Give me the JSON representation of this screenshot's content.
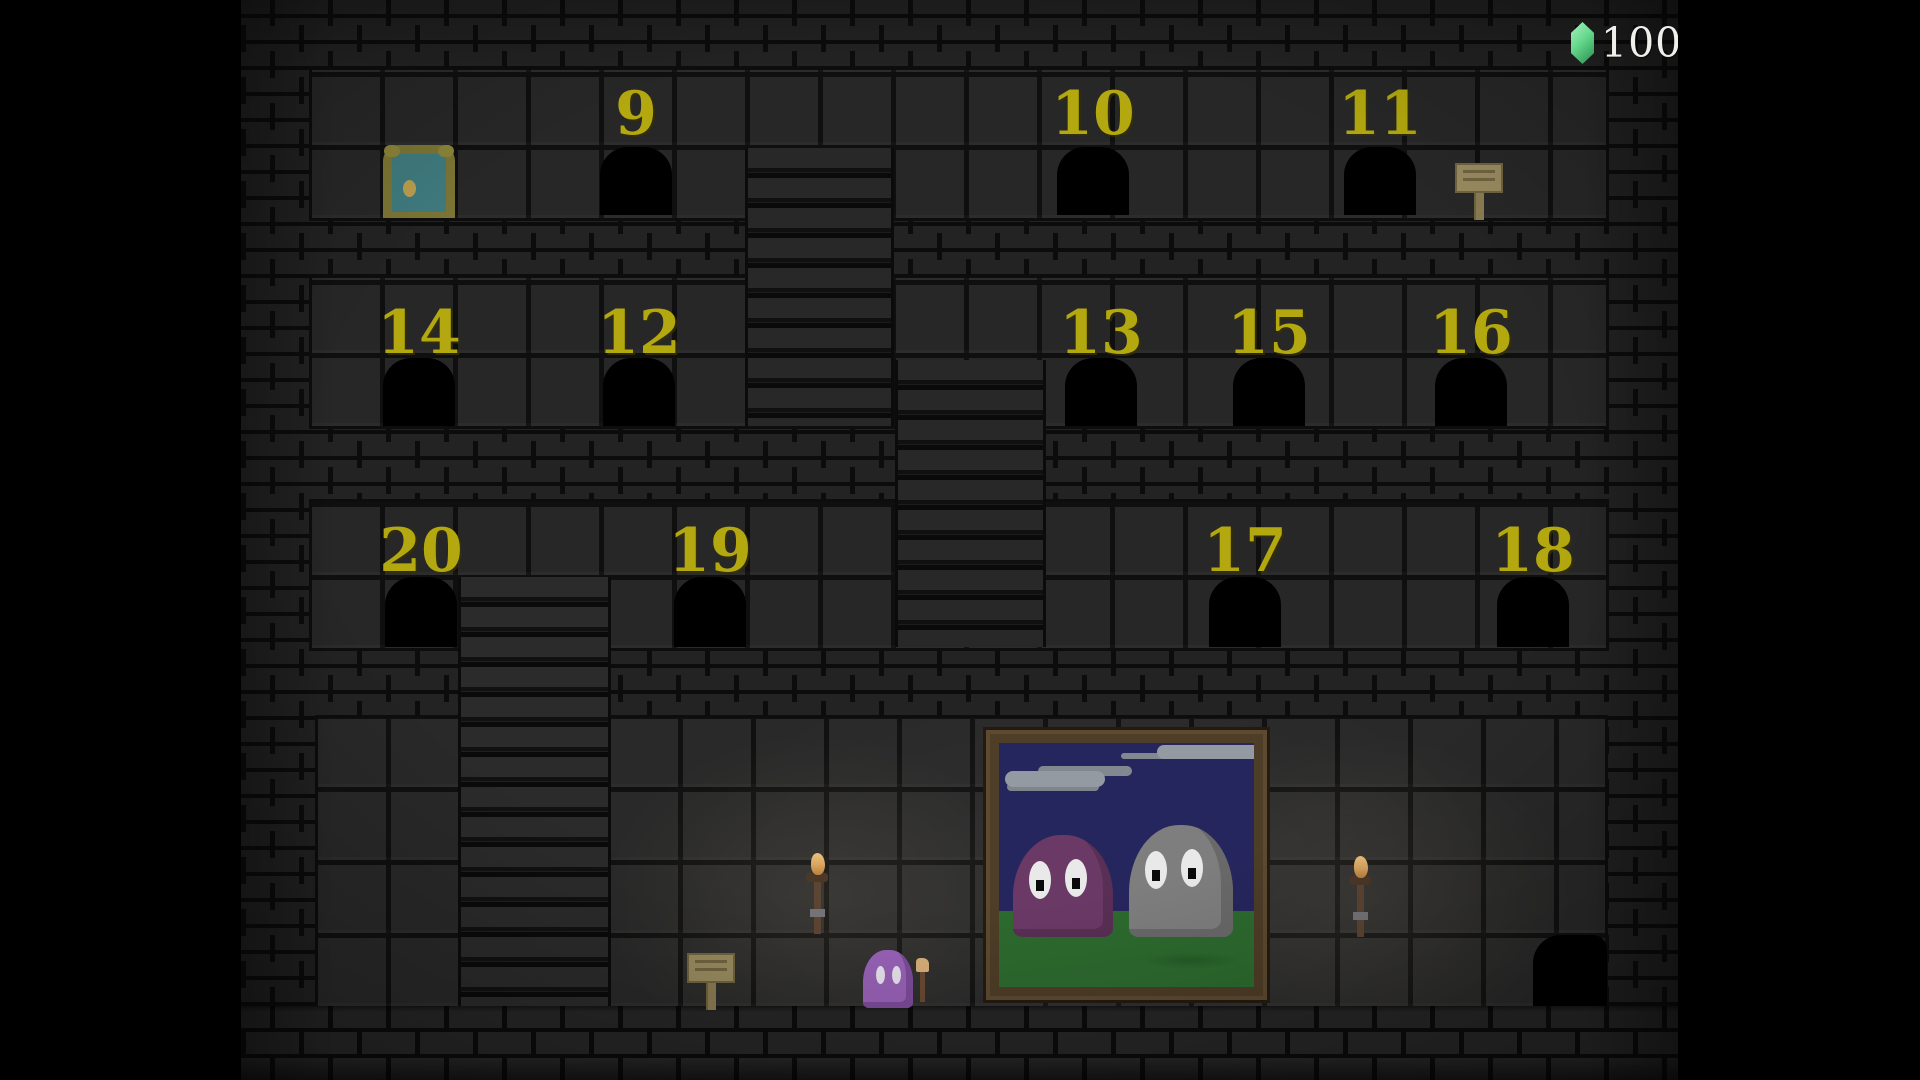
{
  "hud": {
    "rupee_count": "100",
    "rupee_color": "#66d98c",
    "text_color": "#efefec"
  },
  "tower": {
    "floor1": {
      "doors": [
        {
          "label": "9"
        },
        {
          "label": "10"
        },
        {
          "label": "11"
        }
      ]
    },
    "floor2": {
      "doors": [
        {
          "label": "14"
        },
        {
          "label": "12"
        },
        {
          "label": "13"
        },
        {
          "label": "15"
        },
        {
          "label": "16"
        }
      ]
    },
    "floor3": {
      "doors": [
        {
          "label": "20"
        },
        {
          "label": "19"
        },
        {
          "label": "17"
        },
        {
          "label": "18"
        }
      ]
    }
  },
  "colors": {
    "door_number": "#b3a80f",
    "entrance_door": "#3f7a7e",
    "entrance_frame": "#7b7434",
    "sign_wood": "#998b5f",
    "brick": "#232323",
    "tile": "#272727"
  }
}
